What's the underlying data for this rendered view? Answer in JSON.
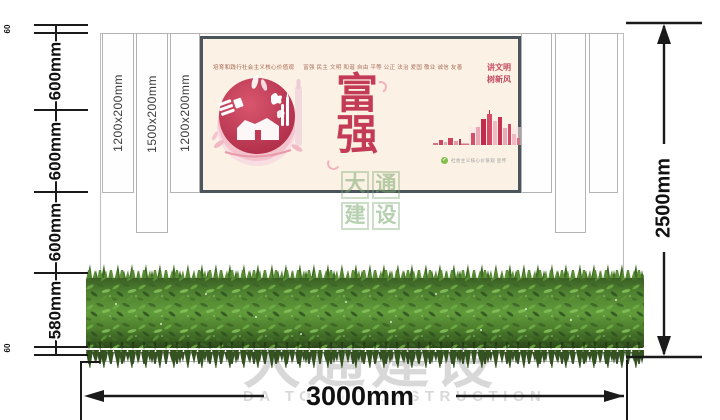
{
  "dimensions": {
    "left_chain": [
      "60",
      "600mm",
      "600mm",
      "600mm",
      "580mm",
      "60"
    ],
    "height_total": "2500mm",
    "width_total": "3000mm",
    "columns": [
      "1200x200mm",
      "1500x200mm",
      "1200x200mm"
    ]
  },
  "panel": {
    "kicker": "培育和践行社会主义核心价值观",
    "values": "富强 民主 文明 和谐 自由 平等 公正 法治 爱国 敬业 诚信 友善",
    "headline": "富强",
    "corner_line1": "讲文明",
    "corner_line2": "树新风",
    "credit": "社会主义核心价值观 宣传"
  },
  "watermark": {
    "center": "大通建设",
    "bottom_cn": "大通建设",
    "bottom_en": "DA TONG CONSTRUCTION"
  },
  "colors": {
    "accent_red": "#c33b56",
    "panel_bg": "#fcf1e5",
    "panel_frame": "#4b555b",
    "hedge_green": "#4a7a2e",
    "dimension_ink": "#1a1a1a",
    "watermark_green": "#7aa86e",
    "watermark_gray": "#c9c9c9"
  }
}
